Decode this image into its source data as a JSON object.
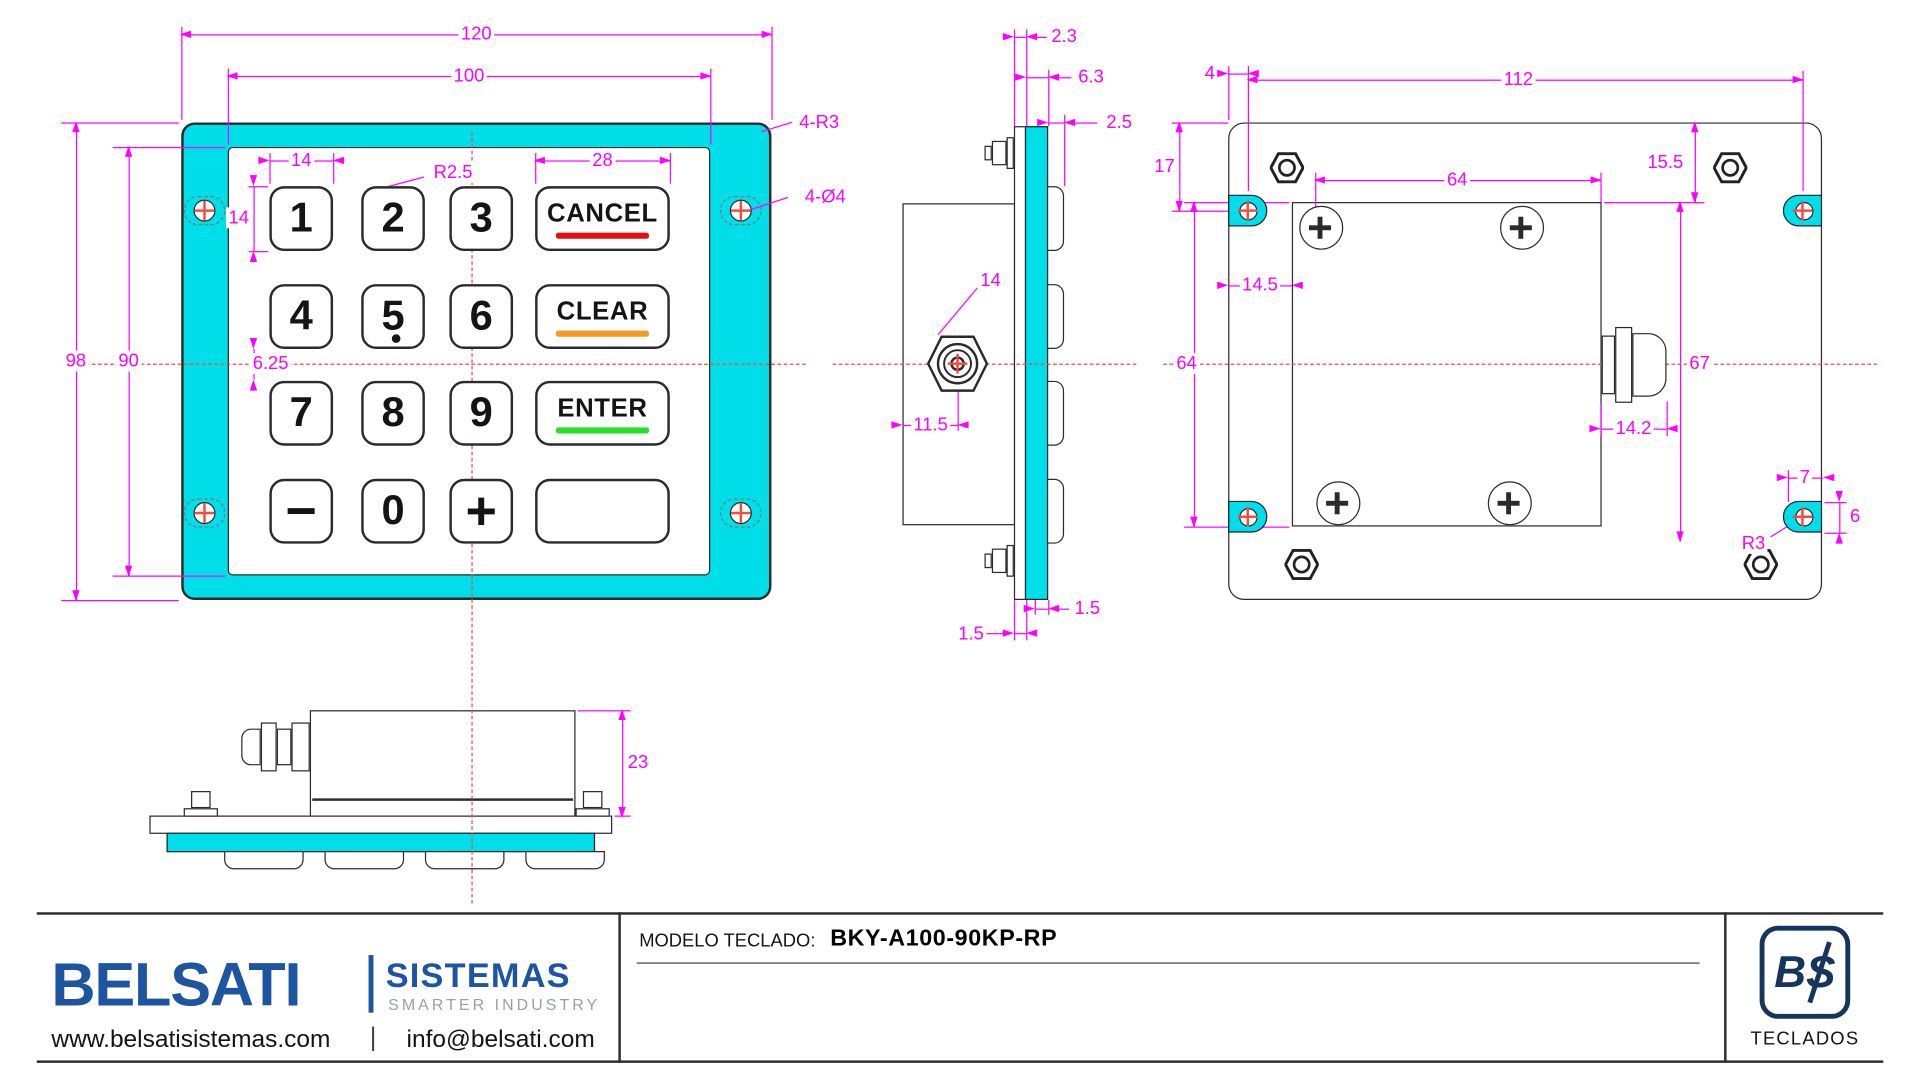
{
  "front_view": {
    "keys": [
      {
        "label": "1"
      },
      {
        "label": "2"
      },
      {
        "label": "3"
      },
      {
        "label": "CANCEL",
        "underline": "#e01010"
      },
      {
        "label": "4"
      },
      {
        "label": "5"
      },
      {
        "label": "6"
      },
      {
        "label": "CLEAR",
        "underline": "#f59a23"
      },
      {
        "label": "7"
      },
      {
        "label": "8"
      },
      {
        "label": "9"
      },
      {
        "label": "ENTER",
        "underline": "#28e028"
      },
      {
        "label": "−"
      },
      {
        "label": "0"
      },
      {
        "label": "+"
      },
      {
        "label": ""
      }
    ],
    "dims": {
      "outer_width": "120",
      "inner_width": "100",
      "outer_height": "98",
      "inner_height": "90",
      "key_width": "14",
      "key_height": "14",
      "key_radius": "R2.5",
      "fn_key_width": "28",
      "frame_radius": "4-R3",
      "mount_hole": "4-Ø4",
      "row_center_offset": "6.25"
    }
  },
  "side_view": {
    "dims": {
      "rear_plate_thk": "2.3",
      "stack_thk": "6.3",
      "key_protrusion": "2.5",
      "gland_dia": "14",
      "gland_offset": "11.5",
      "gap_right": "1.5",
      "gap_bottom": "1.5"
    }
  },
  "back_view": {
    "dims": {
      "slot_edge_inset": "4",
      "slot_span": "112",
      "slot_top_inset": "17",
      "screw_span": "64",
      "box_top_inset": "15.5",
      "box_left_inset": "14.5",
      "box_height": "64",
      "gland_extent": "67",
      "gland_width": "14.2",
      "slot_end_offset": "7",
      "slot_height": "6",
      "slot_radius": "R3"
    }
  },
  "bottom_view": {
    "dims": {
      "enclosure_depth": "23"
    }
  },
  "title_block": {
    "model_label": "MODELO TECLADO:",
    "model_value": "BKY-A100-90KP-RP",
    "brand": "BELSATI",
    "brand_sub": "SISTEMAS",
    "tagline": "SMARTER INDUSTRY",
    "website": "www.belsatisistemas.com",
    "separator": "|",
    "email": "info@belsati.com",
    "logo_mark": "BS",
    "logo_caption": "TECLADOS"
  },
  "colors": {
    "frame_cyan": "#00dfe9",
    "dim_magenta": "#ff00ff",
    "centerline_red": "#f34b3c",
    "cancel_red": "#e01010",
    "clear_orange": "#f59a23",
    "enter_green": "#28e028",
    "brand_blue": "#1d55a1",
    "tagline_gray": "#97a0aa",
    "logo_navy": "#16355e"
  }
}
